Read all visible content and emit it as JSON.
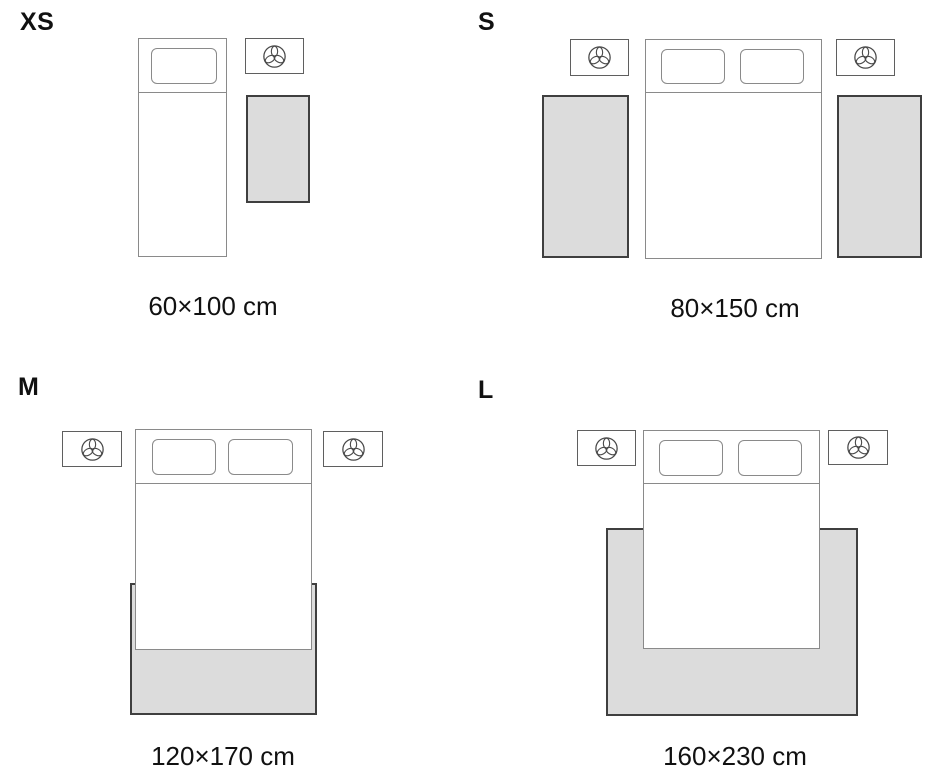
{
  "title": "Rug size guide — bedroom placement diagram",
  "colors": {
    "background": "#ffffff",
    "rug_fill": "#dcdcdc",
    "rug_border": "#3f3f3f",
    "bed_outline": "#8a8a8a",
    "nightstand_outline": "#5f5f5f",
    "icon_stroke": "#4a4a4a",
    "text": "#111111"
  },
  "icons": {
    "lamp": "lamp-icon (trefoil table lamp, top view, inside nightstand)"
  },
  "panels": [
    {
      "id": "xs",
      "label": "XS",
      "size_label": "60×100 cm",
      "bed_type": "single",
      "pillow_count": 1,
      "nightstand_count": 1,
      "rug_count": 1,
      "rug_placement": "beside bed, right side"
    },
    {
      "id": "s",
      "label": "S",
      "size_label": "80×150 cm",
      "bed_type": "double",
      "pillow_count": 2,
      "nightstand_count": 2,
      "rug_count": 2,
      "rug_placement": "runner on each side of bed"
    },
    {
      "id": "m",
      "label": "M",
      "size_label": "120×170 cm",
      "bed_type": "double",
      "pillow_count": 2,
      "nightstand_count": 2,
      "rug_count": 1,
      "rug_placement": "under foot of bed, extending beyond bottom edge"
    },
    {
      "id": "l",
      "label": "L",
      "size_label": "160×230 cm",
      "bed_type": "double",
      "pillow_count": 2,
      "nightstand_count": 2,
      "rug_count": 1,
      "rug_placement": "under bed, extending on both sides and below"
    }
  ]
}
